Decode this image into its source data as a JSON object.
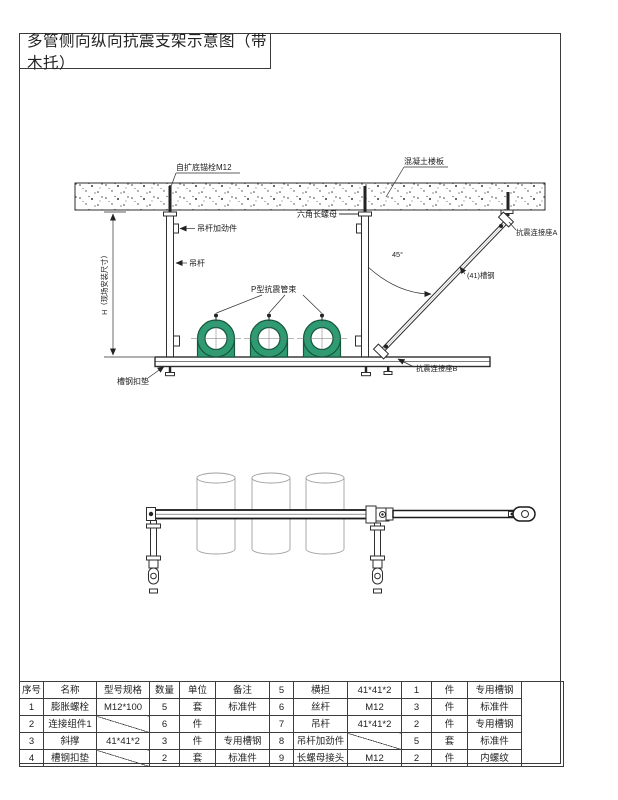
{
  "page": {
    "title": "多管侧向纵向抗震支架示意图（带木托）"
  },
  "diagram": {
    "labels": {
      "anchor_bolt": "自扩底锚栓M12",
      "concrete_slab": "混凝土楼板",
      "hex_long_nut": "六角长螺母",
      "hanger_stiffener": "吊杆加劲件",
      "hanger_rod": "吊杆",
      "pipe_clamp": "P型抗震管束",
      "seismic_connector_a": "抗震连接座A",
      "brace_channel": "(41)槽钢",
      "seismic_connector_b": "抗震连接座B",
      "channel_pad": "槽钢扣垫",
      "height_dim": "H（现场安装尺寸）",
      "angle": "45°"
    },
    "colors": {
      "clamp_fill": "#2f9b72",
      "clamp_stroke": "#17573f",
      "line": "#2e2e2e"
    }
  },
  "table": {
    "rows": [
      [
        "序号",
        "名称",
        "型号规格",
        "数量",
        "单位",
        "备注",
        "5",
        "横担",
        "41*41*2",
        "1",
        "件",
        "专用槽钢"
      ],
      [
        "1",
        "膨胀螺栓",
        "M12*100",
        "5",
        "套",
        "标准件",
        "6",
        "丝杆",
        "M12",
        "3",
        "件",
        "标准件"
      ],
      [
        "2",
        "连接组件1",
        "",
        "6",
        "件",
        "",
        "7",
        "吊杆",
        "41*41*2",
        "2",
        "件",
        "专用槽钢"
      ],
      [
        "3",
        "斜撑",
        "41*41*2",
        "3",
        "件",
        "专用槽钢",
        "8",
        "吊杆加劲件",
        "",
        "5",
        "套",
        "标准件"
      ],
      [
        "4",
        "槽钢扣垫",
        "",
        "2",
        "套",
        "标准件",
        "9",
        "长螺母接头",
        "M12",
        "2",
        "件",
        "内螺纹"
      ]
    ]
  }
}
